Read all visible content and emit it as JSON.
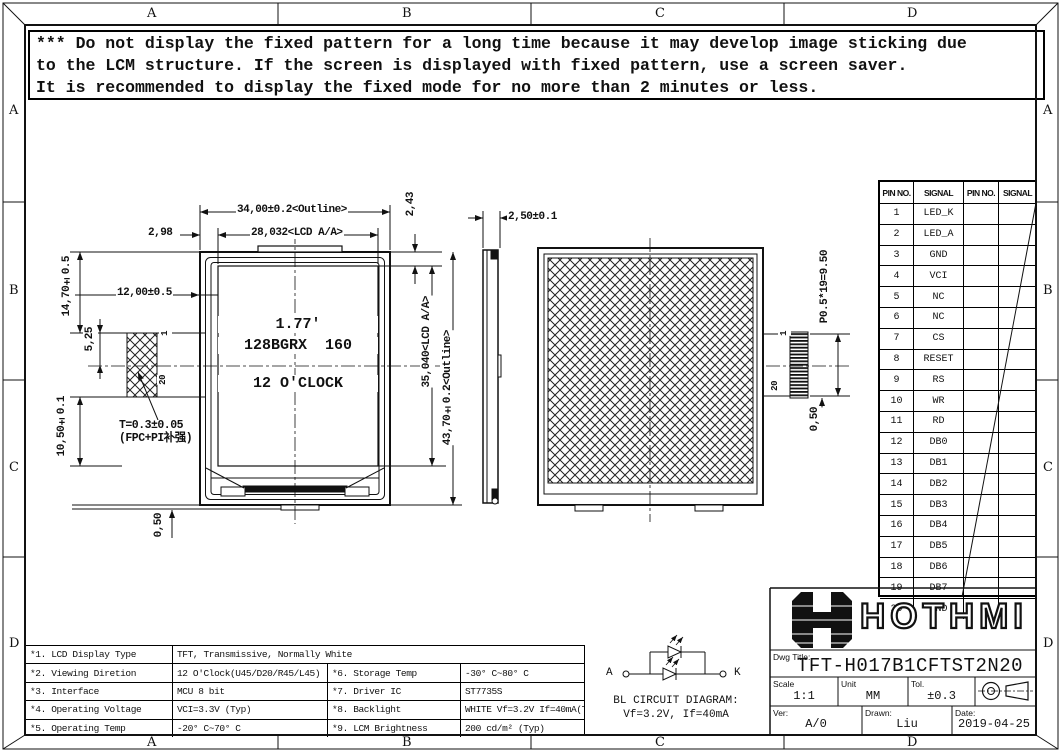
{
  "colors": {
    "ink": "#111111",
    "paper": "#ffffff"
  },
  "frame": {
    "cols": [
      "A",
      "B",
      "C",
      "D"
    ],
    "rows": [
      "A",
      "B",
      "C",
      "D"
    ]
  },
  "warning": {
    "lines": [
      "*** Do not display the fixed pattern for a long time because it may develop image sticking due",
      "to the LCM structure. If the screen is displayed with fixed pattern, use a screen saver.",
      "It is recommended to display the fixed mode for no more than 2 minutes or less."
    ]
  },
  "pin_table": {
    "headers": [
      "PIN NO.",
      "SIGNAL",
      "PIN NO.",
      "SIGNAL"
    ],
    "rows": [
      {
        "no": "1",
        "signal": "LED_K"
      },
      {
        "no": "2",
        "signal": "LED_A"
      },
      {
        "no": "3",
        "signal": "GND"
      },
      {
        "no": "4",
        "signal": "VCI"
      },
      {
        "no": "5",
        "signal": "NC"
      },
      {
        "no": "6",
        "signal": "NC"
      },
      {
        "no": "7",
        "signal": "CS"
      },
      {
        "no": "8",
        "signal": "RESET"
      },
      {
        "no": "9",
        "signal": "RS"
      },
      {
        "no": "10",
        "signal": "WR"
      },
      {
        "no": "11",
        "signal": "RD"
      },
      {
        "no": "12",
        "signal": "DB0"
      },
      {
        "no": "13",
        "signal": "DB1"
      },
      {
        "no": "14",
        "signal": "DB2"
      },
      {
        "no": "15",
        "signal": "DB3"
      },
      {
        "no": "16",
        "signal": "DB4"
      },
      {
        "no": "17",
        "signal": "DB5"
      },
      {
        "no": "18",
        "signal": "DB6"
      },
      {
        "no": "19",
        "signal": "DB7"
      },
      {
        "no": "20",
        "signal": "GND"
      }
    ]
  },
  "views": {
    "front": {
      "display": {
        "line1": "1.77'",
        "line2": "128BGRX  160",
        "line3": "12 O'CLOCK"
      },
      "dims": {
        "outline_w": "34,00±0.2<Outline>",
        "aa_w": "28,032<LCD A/A>",
        "gap_left": "2,98",
        "gap_top": "2,43",
        "aa_h": "35,040<LCD A/A>",
        "outline_h": "43,70±0.2<Outline>",
        "fpc_top": "14,70±0.5",
        "fpc_offset": "12,00±0.5",
        "fpc_mid": "5,25",
        "fpc_bottom": "10,50±0.1",
        "thickness_note1": "T=0.3±0.05",
        "thickness_note2": "(FPC+PI补强)",
        "bottom_gap": "0,50",
        "pin_first": "1",
        "pin_last": "20"
      }
    },
    "side": {
      "dims": {
        "thickness": "2,50±0.1"
      }
    },
    "back": {
      "dims": {
        "pitch": "P0.5*19=9.50",
        "pin_gap": "0,50",
        "pin_first": "1",
        "pin_last": "20"
      }
    }
  },
  "spec_table": {
    "row1": {
      "label": "*1. LCD Display Type",
      "value": "TFT, Transmissive, Normally White"
    },
    "rows": [
      {
        "l1": "*2. Viewing Diretion",
        "v1": "12 O'Clock(U45/D20/R45/L45)",
        "l2": "*6. Storage Temp",
        "v2": "-30° C~80° C"
      },
      {
        "l1": "*3. Interface",
        "v1": "MCU 8 bit",
        "l2": "*7. Driver IC",
        "v2": "ST7735S"
      },
      {
        "l1": "*4. Operating Voltage",
        "v1": "VCI=3.3V (Typ)",
        "l2": "*8. Backlight",
        "v2": "WHITE Vf=3.2V If=40mA(Typ)"
      },
      {
        "l1": "*5. Operating Temp",
        "v1": "-20° C~70° C",
        "l2": "*9. LCM Brightness",
        "v2": "200 cd/m² (Typ)"
      }
    ]
  },
  "bl_circuit": {
    "anode_label": "A",
    "cathode_label": "K",
    "title": "BL CIRCUIT DIAGRAM:",
    "subtitle": "Vf=3.2V, If=40mA"
  },
  "title_block": {
    "logo_text": "HOTHMI",
    "dwg_title_label": "Dwg Title:",
    "dwg_title": "TFT-H017B1CFTST2N20",
    "scale_label": "Scale",
    "scale": "1:1",
    "unit_label": "Unit",
    "unit": "MM",
    "tol_label": "Tol.",
    "tol": "±0.3",
    "ver_label": "Ver:",
    "ver": "A/0",
    "drawn_label": "Drawn:",
    "drawn": "Liu",
    "date_label": "Date:",
    "date": "2019-04-25"
  }
}
